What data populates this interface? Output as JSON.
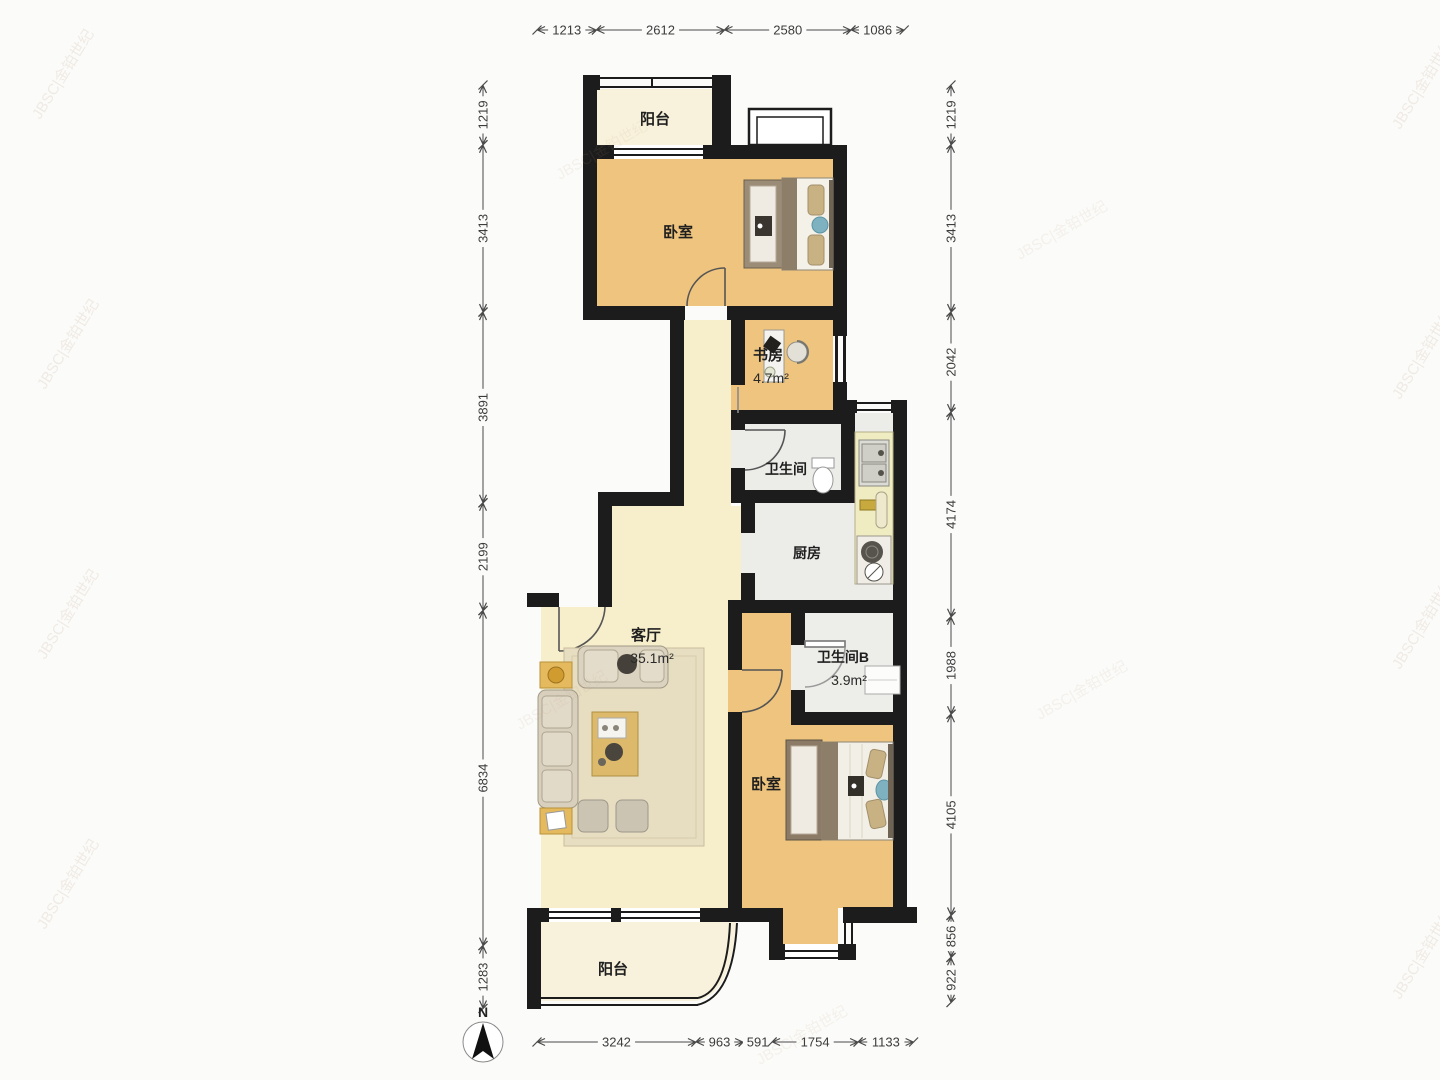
{
  "watermark": {
    "text": "JBSC|金铂世纪"
  },
  "compass": {
    "label": "N"
  },
  "rooms": {
    "balcony_top": {
      "label": "阳台"
    },
    "bedroom_top": {
      "label": "卧室"
    },
    "study": {
      "label": "书房",
      "area": "4.7m²"
    },
    "bathroom": {
      "label": "卫生间"
    },
    "kitchen": {
      "label": "厨房"
    },
    "living_room": {
      "label": "客厅",
      "area": "35.1m²"
    },
    "bathroom_b": {
      "label": "卫生间B",
      "area": "3.9m²"
    },
    "bedroom_bottom": {
      "label": "卧室"
    },
    "balcony_bottom": {
      "label": "阳台"
    }
  },
  "dimensions_mm": {
    "top": [
      1213,
      2612,
      2580,
      1086
    ],
    "left": [
      1219,
      3413,
      3891,
      2199,
      6834,
      1283
    ],
    "right": [
      1219,
      3413,
      2042,
      4174,
      1988,
      4105,
      856,
      922
    ],
    "bottom": [
      3242,
      963,
      591,
      1754,
      1133
    ]
  }
}
